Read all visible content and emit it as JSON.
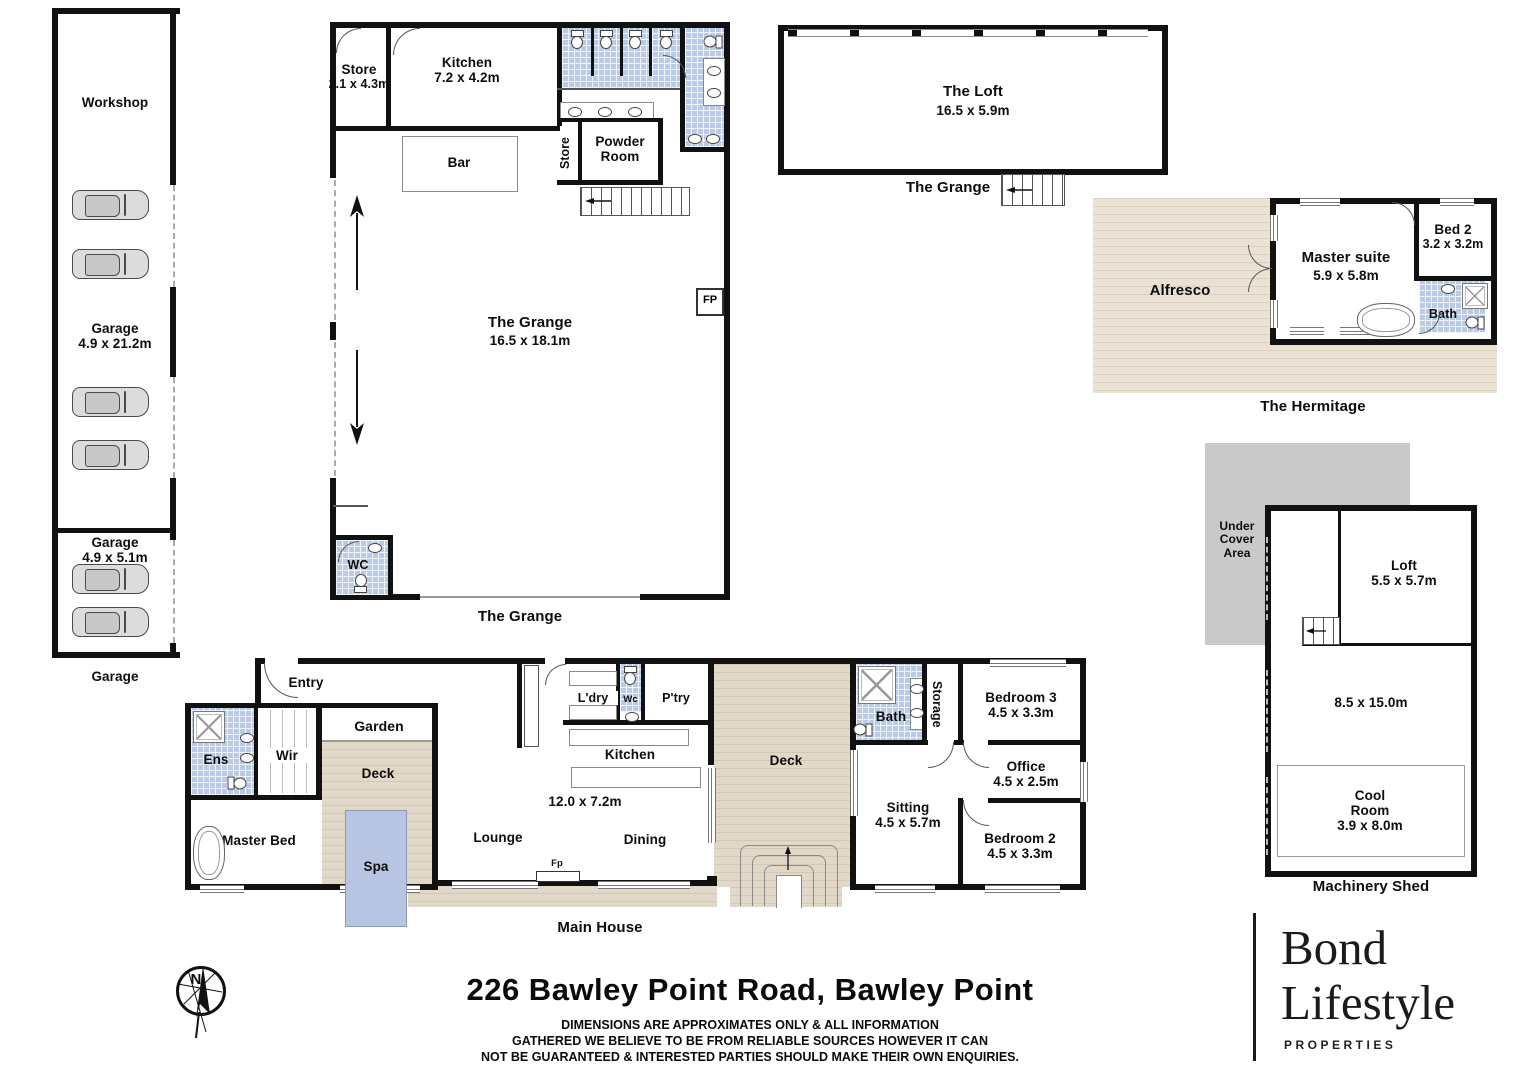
{
  "colors": {
    "wall": "#111111",
    "tile_blue": "#b9cbe7",
    "deck_tan": "#e2d8c8",
    "alfresco_tan": "#eae2d4",
    "spa_blue": "#b8c5e2",
    "under_cover_gray": "#c9c9c9"
  },
  "garage_building": {
    "workshop": "Workshop",
    "garage1": "Garage",
    "garage1_dim": "4.9 x 21.2m",
    "garage2": "Garage",
    "garage2_dim": "4.9 x 5.1m",
    "caption": "Garage"
  },
  "grange": {
    "store_room": "Store",
    "store_room_dim": "2.1 x 4.3m",
    "kitchen": "Kitchen",
    "kitchen_dim": "7.2 x 4.2m",
    "bar": "Bar",
    "store2": "Store",
    "powder_room": "Powder Room",
    "hall": "The Grange",
    "hall_dim": "16.5 x 18.1m",
    "fp": "FP",
    "wc": "WC",
    "caption": "The Grange"
  },
  "loft_building": {
    "name": "The Loft",
    "dim": "16.5 x 5.9m",
    "caption": "The Grange"
  },
  "hermitage": {
    "alfresco": "Alfresco",
    "master": "Master suite",
    "master_dim": "5.9 x 5.8m",
    "bed2": "Bed 2",
    "bed2_dim": "3.2 x 3.2m",
    "bath": "Bath",
    "caption": "The Hermitage"
  },
  "shed": {
    "under_cover": "Under Cover Area",
    "loft": "Loft",
    "loft_dim": "5.5 x 5.7m",
    "main_dim": "8.5 x 15.0m",
    "cool_room": "Cool Room",
    "cool_room_dim": "3.9 x 8.0m",
    "caption": "Machinery Shed"
  },
  "house": {
    "entry": "Entry",
    "ens": "Ens",
    "wir": "Wir",
    "garden": "Garden",
    "deck1": "Deck",
    "spa": "Spa",
    "master_bed": "Master Bed",
    "lounge": "Lounge",
    "ldry": "L'dry",
    "wc": "Wc",
    "ptry": "P'try",
    "kitchen": "Kitchen",
    "living_dim": "12.0 x 7.2m",
    "dining": "Dining",
    "deck2": "Deck",
    "fp": "Fp",
    "bath": "Bath",
    "storage": "Storage",
    "bed3": "Bedroom 3",
    "bed3_dim": "4.5 x 3.3m",
    "office": "Office",
    "office_dim": "4.5 x 2.5m",
    "sitting": "Sitting",
    "sitting_dim": "4.5 x 5.7m",
    "bed2": "Bedroom 2",
    "bed2_dim": "4.5 x 3.3m",
    "caption": "Main House"
  },
  "footer": {
    "address": "226 Bawley Point Road, Bawley Point",
    "disclaimer_line1": "DIMENSIONS ARE APPROXIMATES ONLY & ALL INFORMATION",
    "disclaimer_line2": "GATHERED WE BELIEVE TO BE FROM RELIABLE SOURCES HOWEVER IT CAN",
    "disclaimer_line3": "NOT BE GUARANTEED & INTERESTED PARTIES SHOULD MAKE THEIR OWN ENQUIRIES."
  },
  "compass": {
    "north": "N"
  },
  "logo": {
    "name_line1": "Bond",
    "name_line2": "Lifestyle",
    "tagline": "PROPERTIES"
  },
  "icons": [
    "north-compass-icon",
    "car-icon",
    "toilet-icon",
    "basin-icon",
    "shower-icon",
    "bathtub-icon",
    "spa-icon",
    "stairs-icon",
    "fireplace-icon",
    "door-arc-icon",
    "direction-arrow-icon"
  ]
}
